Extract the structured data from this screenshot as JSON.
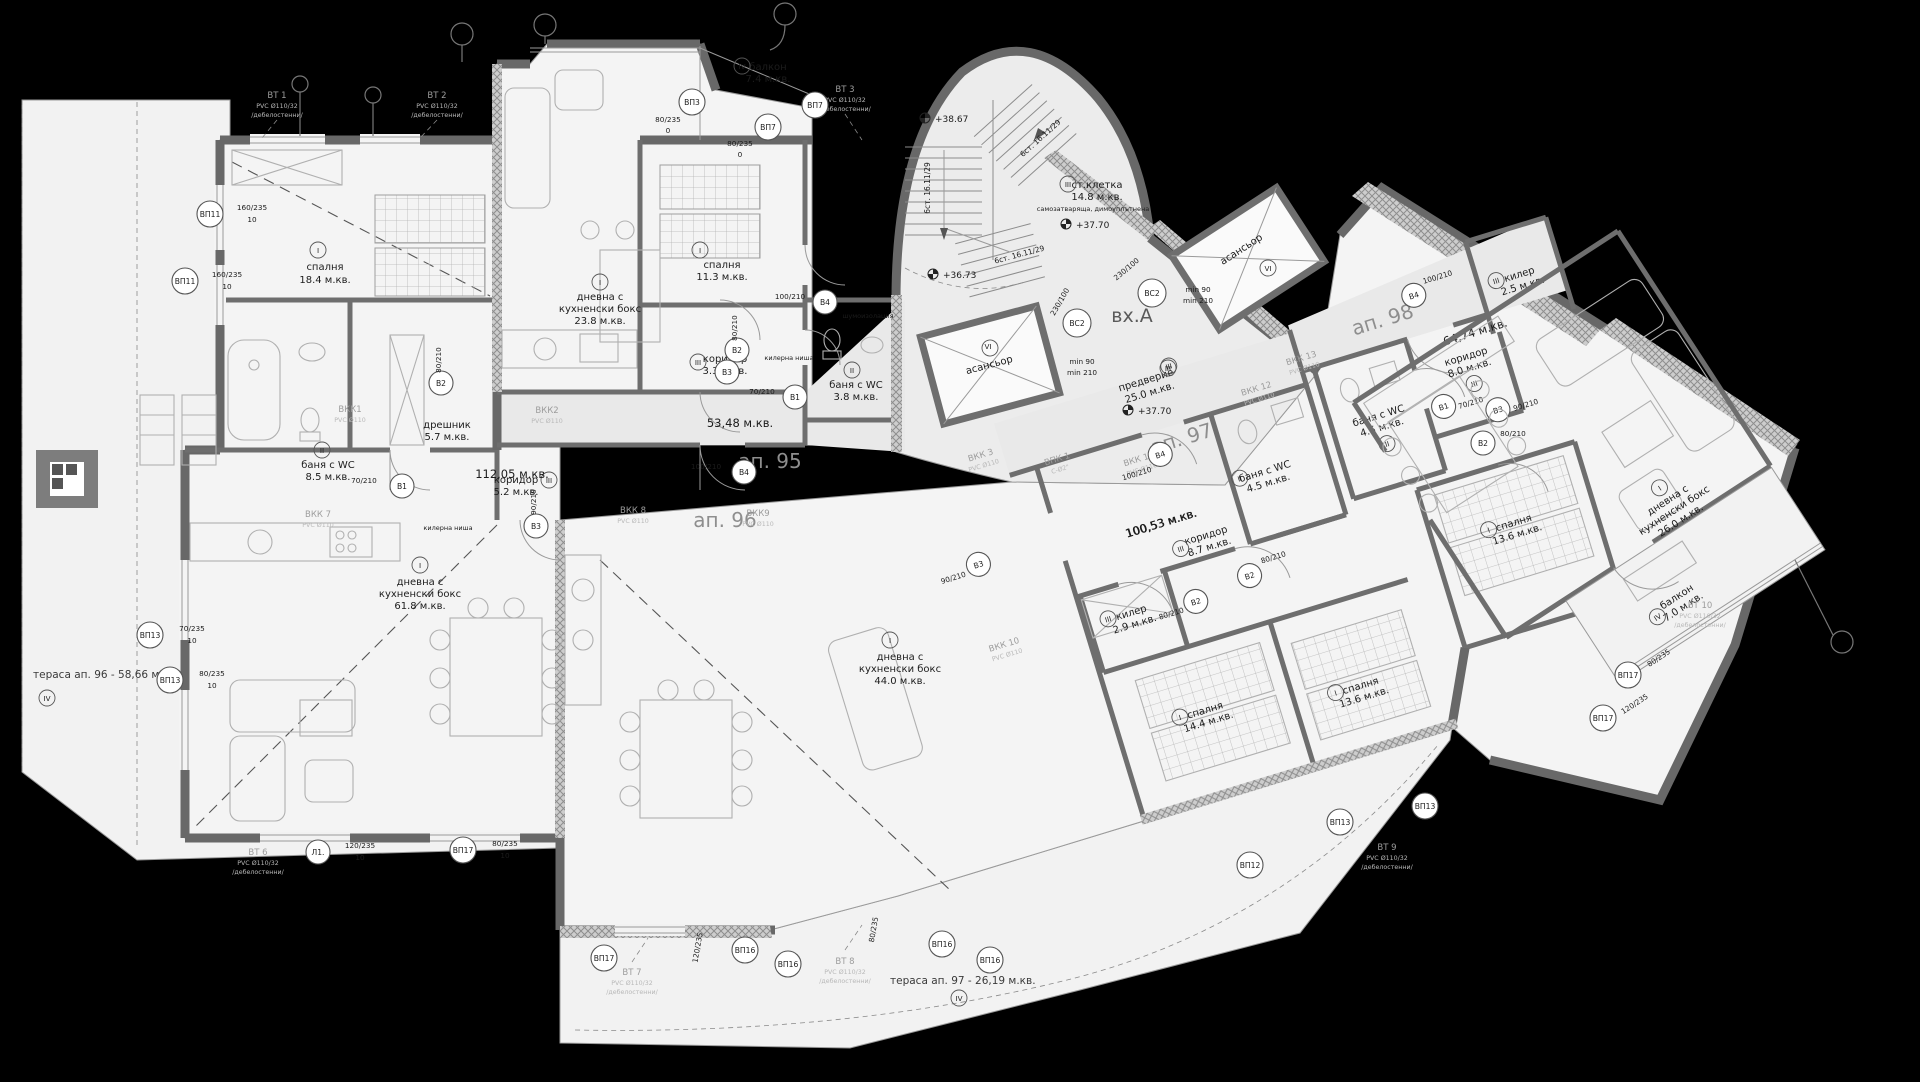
{
  "apartments": {
    "a95": {
      "num": "ап. 95",
      "area": "53,48 м.кв."
    },
    "a96": {
      "num": "ап. 96",
      "area": "112,05 м.кв."
    },
    "a97": {
      "num": "ап. 97",
      "area": "100,53 м.кв."
    },
    "a98": {
      "num": "ап. 98",
      "area": "64,74 м.кв."
    }
  },
  "entrance": {
    "name": "вх.А",
    "vest": "предверие",
    "vest_area": "25.0 м.кв.",
    "stair": "ст.клетка",
    "stair_area": "14.8 м.кв.",
    "stair_note": "самозатваряща, димоуплътнена",
    "steps": "6ст. 16.11/29",
    "lift": "асансьор",
    "min_w": "min 90",
    "min_d": "min 210",
    "lvl_a": "+38.67",
    "lvl_b": "+36.73",
    "lvl_c": "+37.70",
    "lvl_d": "+37.70"
  },
  "terraces": {
    "t96": "тераса ап. 96 - 58,66 м.кв.",
    "t97": "тераса ап. 97 - 26,19 м.кв."
  },
  "rooms": {
    "bed": "спалня",
    "live1": "дневна с",
    "live2": "кухненски бокс",
    "bath": "баня с WC",
    "cor": "коридор",
    "dress": "дрешник",
    "store": "килер",
    "balc": "балкон",
    "niche": "килерна ниша",
    "sound": "шумоизолация",
    "areas": {
      "bed96": "18.4 м.кв.",
      "bath96": "8.5 м.кв.",
      "dress96": "5.7 м.кв.",
      "cor96": "5.2 м.кв.",
      "liv96": "61.8 м.кв.",
      "liv95": "23.8 м.кв.",
      "bed95": "11.3 м.кв.",
      "cor95": "3.3 м.кв.",
      "bath95": "3.8 м.кв.",
      "balc95": "7.4 м.кв.",
      "liv97": "44.0 м.кв.",
      "cor97": "8.7 м.кв.",
      "store97": "2.9 м.кв.",
      "bed97a": "14.4 м.кв.",
      "bed97b": "13.6 м.кв.",
      "bath97": "4.5 м.кв.",
      "cor98": "8.0 м.кв.",
      "store98": "2.5 м.кв.",
      "bath98": "4.5 м.кв.",
      "bed98": "13.6 м.кв.",
      "liv98": "26.0 м.кв.",
      "balc98": "7.0 м.кв."
    }
  },
  "marks": {
    "b1": "В1",
    "b2": "В2",
    "b3": "В3",
    "b4": "В4",
    "bs2": "ВС2",
    "vp3": "ВП3",
    "vp7": "ВП7",
    "vp11": "ВП11",
    "vp12": "ВП12",
    "vp13": "ВП13",
    "vp16": "ВП16",
    "vp17": "ВП17",
    "l1": "Л1.",
    "z1": "I",
    "z2": "II",
    "z3": "III",
    "z4": "IV",
    "z6": "VI"
  },
  "dims": {
    "s160": "160/235",
    "s120": "120/235",
    "s80": "80/235",
    "s70": "70/235",
    "n10": "10",
    "n0": "0",
    "d70": "70/210",
    "d80": "80/210",
    "d90": "90/210",
    "d100": "100/210",
    "d230": "230/100"
  },
  "risers": {
    "vt1": "ВТ 1",
    "vt2": "ВТ 2",
    "vt3": "ВТ 3",
    "vt6": "ВТ 6",
    "vt7": "ВТ 7",
    "vt8": "ВТ 8",
    "vt9": "ВТ 9",
    "vt10": "ВТ 10",
    "spec32": "PVC Ø110/32",
    "note": "/дебелостенни/",
    "vkk1": "ВКК1",
    "vkk2": "ВКК2",
    "vkk3": "ВКК 3",
    "vkk7": "ВКК 7",
    "vkk8": "ВКК 8",
    "vkk9": "ВКК9",
    "vkk10": "ВКК 10",
    "vkk11": "ВКК 11",
    "vkk12": "ВКК 12",
    "vkk13": "ВКК 13",
    "spec110": "PVC Ø110",
    "vpk1": "ВПК 1",
    "vpk1s": "C-Ø2\"",
    "vs2": "ВС2"
  }
}
